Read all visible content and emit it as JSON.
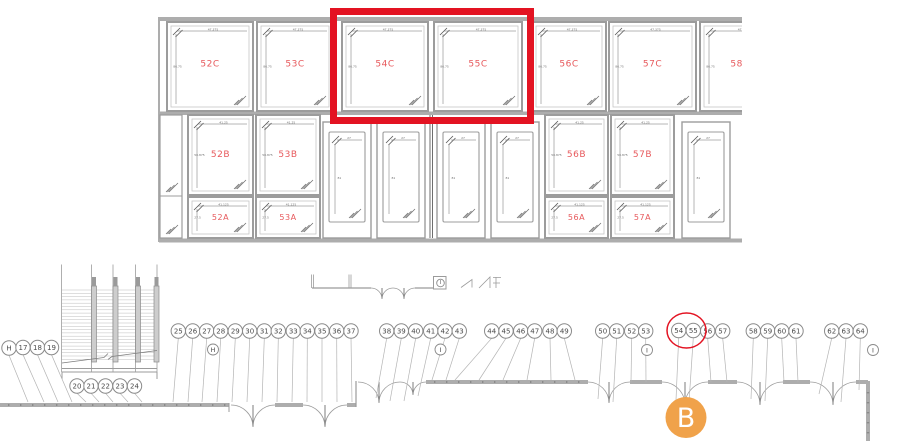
{
  "colors": {
    "frame_gray": "#9c9c9c",
    "frame_light": "#c6c6c6",
    "band_gray": "#adadad",
    "tick_gray": "#8a8a8a",
    "dim_gray": "#6f6f6f",
    "plan_gray": "#9b9b9b",
    "leader_gray": "#b4b4b4",
    "label_red": "#e7595c",
    "highlight_red": "#e31322",
    "badge_orange": "#f0a24a",
    "circle_text": "#4a4a4a"
  },
  "elevation": {
    "row_dims": {
      "C": {
        "top": "47.375",
        "side": "86.75"
      },
      "B": {
        "top": "41.25",
        "side": "50.875"
      },
      "A": {
        "top": "41.125",
        "side": "27.5"
      },
      "door": {
        "top": "27",
        "side": "81"
      }
    },
    "panels": [
      {
        "label": "52C",
        "row": "C",
        "x": 167,
        "w": 86
      },
      {
        "label": "53C",
        "row": "C",
        "x": 257,
        "w": 76
      },
      {
        "label": "54C",
        "row": "C",
        "x": 342,
        "w": 86,
        "highlighted": true
      },
      {
        "label": "55C",
        "row": "C",
        "x": 434,
        "w": 88,
        "highlighted": true
      },
      {
        "label": "56C",
        "row": "C",
        "x": 532,
        "w": 74
      },
      {
        "label": "57C",
        "row": "C",
        "x": 609,
        "w": 87
      },
      {
        "label": "58C",
        "row": "C",
        "x": 700,
        "w": 80,
        "clipped": true
      },
      {
        "label": "52B",
        "row": "B",
        "x": 188,
        "w": 65
      },
      {
        "label": "53B",
        "row": "B",
        "x": 256,
        "w": 64
      },
      {
        "label": "56B",
        "row": "B",
        "x": 545,
        "w": 63
      },
      {
        "label": "57B",
        "row": "B",
        "x": 611,
        "w": 63
      },
      {
        "label": "52A",
        "row": "A",
        "x": 188,
        "w": 65
      },
      {
        "label": "53A",
        "row": "A",
        "x": 256,
        "w": 64
      },
      {
        "label": "56A",
        "row": "A",
        "x": 545,
        "w": 63
      },
      {
        "label": "57A",
        "row": "A",
        "x": 611,
        "w": 63
      }
    ],
    "doors": [
      {
        "x": 323,
        "w": 48
      },
      {
        "x": 377,
        "w": 48
      },
      {
        "x": 437,
        "w": 48
      },
      {
        "x": 491,
        "w": 48
      },
      {
        "x": 682,
        "w": 48,
        "clipped": true
      }
    ]
  },
  "plan": {
    "callouts": [
      {
        "n": "H",
        "x": 9,
        "y": 348,
        "fx": 28,
        "fy": 402
      },
      {
        "n": "17",
        "x": 23,
        "y": 347.5,
        "fx": 44,
        "fy": 402
      },
      {
        "n": "18",
        "x": 37.5,
        "y": 347.5,
        "fx": 58,
        "fy": 402
      },
      {
        "n": "19",
        "x": 51.5,
        "y": 347.5,
        "fx": 72,
        "fy": 402
      },
      {
        "n": "20",
        "x": 77,
        "y": 386,
        "fx": 86,
        "fy": 402
      },
      {
        "n": "21",
        "x": 91,
        "y": 386,
        "fx": 99,
        "fy": 402
      },
      {
        "n": "22",
        "x": 105.5,
        "y": 386,
        "fx": 113,
        "fy": 402
      },
      {
        "n": "23",
        "x": 120,
        "y": 386,
        "fx": 128,
        "fy": 402
      },
      {
        "n": "24",
        "x": 134.5,
        "y": 386,
        "fx": 142,
        "fy": 402
      },
      {
        "n": "25",
        "x": 178.3,
        "y": 331,
        "fx": 173,
        "fy": 402
      },
      {
        "n": "26",
        "x": 192.7,
        "y": 331,
        "fx": 188,
        "fy": 402
      },
      {
        "n": "27",
        "x": 206.7,
        "y": 331,
        "fx": 202,
        "fy": 402
      },
      {
        "n": "28",
        "x": 220.7,
        "y": 331,
        "fx": 217,
        "fy": 402
      },
      {
        "n": "29",
        "x": 235.3,
        "y": 331,
        "fx": 232,
        "fy": 402
      },
      {
        "n": "30",
        "x": 249.7,
        "y": 331,
        "fx": 247,
        "fy": 402
      },
      {
        "n": "31",
        "x": 264.3,
        "y": 331,
        "fx": 262,
        "fy": 402
      },
      {
        "n": "32",
        "x": 278.3,
        "y": 331,
        "fx": 277,
        "fy": 402
      },
      {
        "n": "33",
        "x": 293.3,
        "y": 331,
        "fx": 292,
        "fy": 402
      },
      {
        "n": "34",
        "x": 307.3,
        "y": 331,
        "fx": 307,
        "fy": 402
      },
      {
        "n": "35",
        "x": 322,
        "y": 331,
        "fx": 322,
        "fy": 402
      },
      {
        "n": "36",
        "x": 336.7,
        "y": 331,
        "fx": 337,
        "fy": 402
      },
      {
        "n": "37",
        "x": 351,
        "y": 331,
        "fx": 352,
        "fy": 402
      },
      {
        "n": "38",
        "x": 386.7,
        "y": 331,
        "fx": 376,
        "fy": 398
      },
      {
        "n": "39",
        "x": 401.3,
        "y": 331,
        "fx": 390,
        "fy": 401
      },
      {
        "n": "40",
        "x": 415.7,
        "y": 331,
        "fx": 404,
        "fy": 401
      },
      {
        "n": "41",
        "x": 430.7,
        "y": 331,
        "fx": 418,
        "fy": 396
      },
      {
        "n": "42",
        "x": 445,
        "y": 331,
        "fx": 432,
        "fy": 380
      },
      {
        "n": "43",
        "x": 459.3,
        "y": 331,
        "fx": 446,
        "fy": 380
      },
      {
        "n": "44",
        "x": 491.7,
        "y": 331,
        "fx": 455,
        "fy": 380
      },
      {
        "n": "45",
        "x": 506,
        "y": 331,
        "fx": 479,
        "fy": 380
      },
      {
        "n": "46",
        "x": 520.7,
        "y": 331,
        "fx": 503,
        "fy": 380
      },
      {
        "n": "47",
        "x": 534.7,
        "y": 331,
        "fx": 527,
        "fy": 380
      },
      {
        "n": "48",
        "x": 550,
        "y": 331,
        "fx": 551,
        "fy": 380
      },
      {
        "n": "49",
        "x": 564.3,
        "y": 331,
        "fx": 575,
        "fy": 380
      },
      {
        "n": "50",
        "x": 602.7,
        "y": 331,
        "fx": 598,
        "fy": 399
      },
      {
        "n": "51",
        "x": 616.7,
        "y": 331,
        "fx": 613,
        "fy": 402
      },
      {
        "n": "52",
        "x": 631.7,
        "y": 331,
        "fx": 631,
        "fy": 382
      },
      {
        "n": "53",
        "x": 645.7,
        "y": 331,
        "fx": 646,
        "fy": 382
      },
      {
        "n": "54",
        "x": 678.7,
        "y": 330.5,
        "fx": 676,
        "fy": 400,
        "circled": true
      },
      {
        "n": "55",
        "x": 693.3,
        "y": 330.5,
        "fx": 689,
        "fy": 402,
        "circled": true
      },
      {
        "n": "56",
        "x": 707.7,
        "y": 331,
        "fx": 711,
        "fy": 382
      },
      {
        "n": "57",
        "x": 722.7,
        "y": 331,
        "fx": 727,
        "fy": 382
      },
      {
        "n": "58",
        "x": 753.3,
        "y": 331,
        "fx": 751,
        "fy": 399
      },
      {
        "n": "59",
        "x": 767.7,
        "y": 331,
        "fx": 765,
        "fy": 401
      },
      {
        "n": "60",
        "x": 781.7,
        "y": 331,
        "fx": 784,
        "fy": 382
      },
      {
        "n": "61",
        "x": 796,
        "y": 331,
        "fx": 798,
        "fy": 382
      },
      {
        "n": "62",
        "x": 831.7,
        "y": 331,
        "fx": 819,
        "fy": 394
      },
      {
        "n": "63",
        "x": 846,
        "y": 331,
        "fx": 841,
        "fy": 402
      },
      {
        "n": "64",
        "x": 860.3,
        "y": 331,
        "fx": 859,
        "fy": 390
      }
    ],
    "letter_callouts": [
      {
        "n": "H",
        "x": 213,
        "y": 349.5,
        "r": 5.5
      },
      {
        "n": "I",
        "x": 440.5,
        "y": 283,
        "r": 3.8
      },
      {
        "n": "I",
        "x": 440.5,
        "y": 349.5,
        "r": 5.5
      },
      {
        "n": "I",
        "x": 647,
        "y": 350,
        "r": 5.5
      },
      {
        "n": "I",
        "x": 873,
        "y": 350,
        "r": 5.5
      }
    ],
    "annotations": {
      "highlight_box_panels": "54C, 55C",
      "circled_callouts": "54, 55",
      "section_badge": {
        "label": "B"
      }
    }
  }
}
